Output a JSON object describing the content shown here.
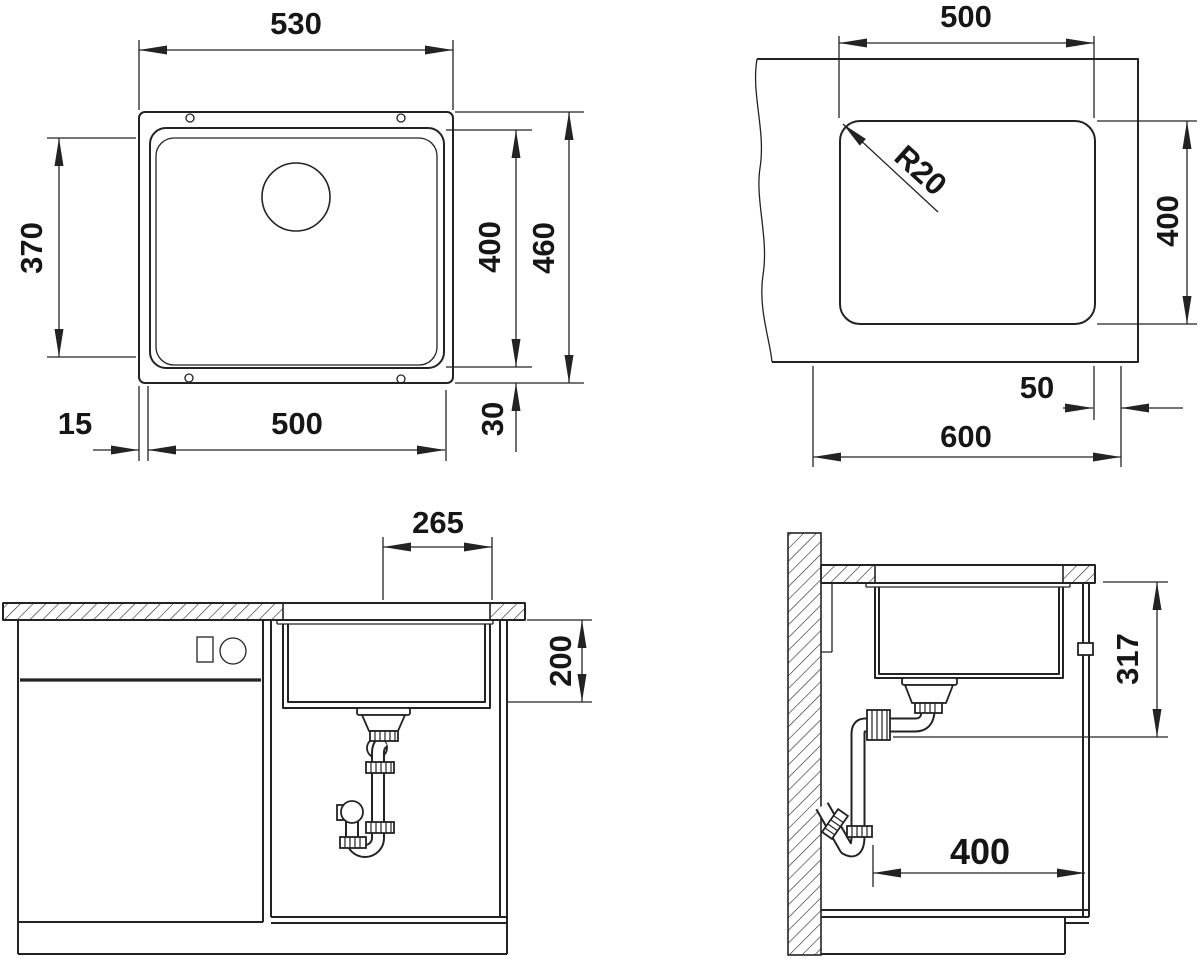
{
  "drawing": {
    "kind": "sink installation technical drawing",
    "background_color": "#ffffff",
    "line_color": "#232323",
    "dims": {
      "top_view": {
        "outer_width": "530",
        "inner_depth": "370",
        "bowl_depth": "400",
        "outer_depth": "460",
        "bowl_width": "500",
        "offset_left": "15",
        "offset_bottom": "30"
      },
      "cutout_view": {
        "width": "500",
        "corner_radius": "R20",
        "depth": "400",
        "rear_offset": "50",
        "cabinet_width": "600"
      },
      "front_view": {
        "drain_offset": "265",
        "bowl_height": "200"
      },
      "side_view": {
        "mounting_depth": "317",
        "base_clearance": "400"
      }
    }
  }
}
